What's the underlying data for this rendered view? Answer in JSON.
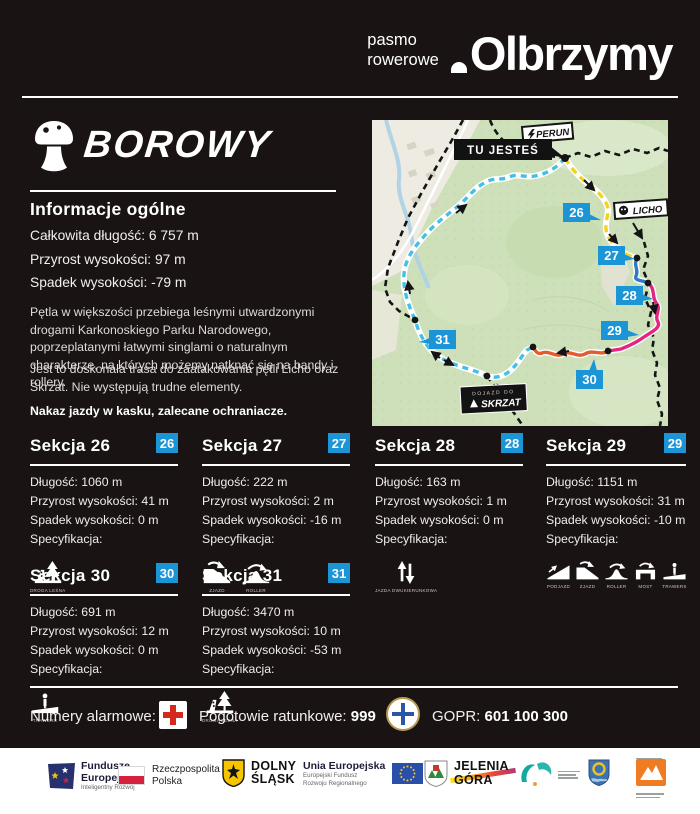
{
  "header": {
    "brand_small_line1": "pasmo",
    "brand_small_line2": "rowerowe",
    "brand_big": "Olbrzymy"
  },
  "trail": {
    "name": "BOROWY",
    "info_heading": "Informacje ogólne",
    "stat_length": "Całkowita długość:  6 757 m",
    "stat_gain": "Przyrost wysokości:  97 m",
    "stat_drop": "Spadek wysokości:  -79 m",
    "description_1": "Pętla w większości przebiega leśnymi utwardzonymi drogami Karkonoskiego Parku Narodowego, poprzeplatanymi łatwymi singlami o naturalnym charakterze, na których możemy natknąć się na bandy i rollery.",
    "description_2": "Jest to doskonała trasa do zaatakowania pętli Licho oraz Skrzat. Nie występują trudne elementy.",
    "note": "Nakaz jazdy w kasku, zalecane ochraniacze."
  },
  "map": {
    "you_are_here": "TU JESTEŚ",
    "label_perun": "PERUN",
    "label_licho": "LICHO",
    "label_skrzat_line1": "DOJAZD DO",
    "label_skrzat_line2": "SKRZAT",
    "badge_26": "26",
    "badge_27": "27",
    "badge_28": "28",
    "badge_29": "29",
    "badge_30": "30",
    "badge_31": "31"
  },
  "sections": [
    {
      "title": "Sekcja 26",
      "badge": "26",
      "length": "Długość: 1060 m",
      "gain": "Przyrost wysokości: 41 m",
      "drop": "Spadek wysokości: 0 m",
      "spec": "Specyfikacja:",
      "icons": [
        {
          "name": "droga-lesna",
          "label": "DROGA LEŚNA"
        }
      ]
    },
    {
      "title": "Sekcja 27",
      "badge": "27",
      "length": "Długość: 222 m",
      "gain": "Przyrost wysokości: 2 m",
      "drop": "Spadek wysokości: -16 m",
      "spec": "Specyfikacja:",
      "icons": [
        {
          "name": "zjazd",
          "label": "ZJAZD"
        },
        {
          "name": "roller",
          "label": "ROLLER"
        }
      ]
    },
    {
      "title": "Sekcja 28",
      "badge": "28",
      "length": "Długość: 163 m",
      "gain": "Przyrost wysokości: 1 m",
      "drop": "Spadek wysokości: 0 m",
      "spec": "Specyfikacja:",
      "icons": [
        {
          "name": "jazda-dwukierunkowa",
          "label": "JAZDA DWUKIERUNKOWA"
        }
      ]
    },
    {
      "title": "Sekcja 29",
      "badge": "29",
      "length": "Długość: 1151 m",
      "gain": "Przyrost wysokości: 31 m",
      "drop": "Spadek wysokości: -10 m",
      "spec": "Specyfikacja:",
      "icons": [
        {
          "name": "podjazd",
          "label": "PODJAZD"
        },
        {
          "name": "zjazd",
          "label": "ZJAZD"
        },
        {
          "name": "roller",
          "label": "ROLLER"
        },
        {
          "name": "most",
          "label": "MOST"
        },
        {
          "name": "trawers",
          "label": "TRAWERS"
        }
      ]
    },
    {
      "title": "Sekcja 30",
      "badge": "30",
      "length": "Długość: 691 m",
      "gain": "Przyrost wysokości: 12 m",
      "drop": "Spadek wysokości: 0 m",
      "spec": "Specyfikacja:",
      "icons": [
        {
          "name": "trawers",
          "label": "TRAWERS"
        }
      ]
    },
    {
      "title": "Sekcja 31",
      "badge": "31",
      "length": "Długość: 3470 m",
      "gain": "Przyrost wysokości: 10 m",
      "drop": "Spadek wysokości: -53 m",
      "spec": "Specyfikacja:",
      "icons": [
        {
          "name": "droga-lesna",
          "label": "DROGA LEŚNA"
        }
      ]
    }
  ],
  "emergency": {
    "label": "Numery alarmowe:",
    "ambulance_label": "Pogotowie ratunkowe: ",
    "ambulance_number": "999",
    "gopr_label": "GOPR: ",
    "gopr_number": "601 100 300"
  },
  "footer": {
    "fe_line1": "Fundusze",
    "fe_line2": "Europejskie",
    "fe_line3": "Inteligentny Rozwój",
    "pl_line1": "Rzeczpospolita",
    "pl_line2": "Polska",
    "ds_line1": "DOLNY",
    "ds_line2": "ŚLĄSK",
    "ue_line1": "Unia Europejska",
    "ue_line2": "Europejski Fundusz",
    "ue_line3": "Rozwoju Regionalnego",
    "jg_line1": "JELENIA",
    "jg_line2": "GÓRA"
  },
  "colors": {
    "badge_blue": "#1b95d5",
    "route_yellow": "#f2d41f",
    "route_pink": "#e4267f",
    "route_orange": "#e65b2d",
    "route_cyan": "#45bfe8",
    "route_blue": "#2e7cc3",
    "cross_red": "#d6291e",
    "map_green": "#cde0ba"
  }
}
